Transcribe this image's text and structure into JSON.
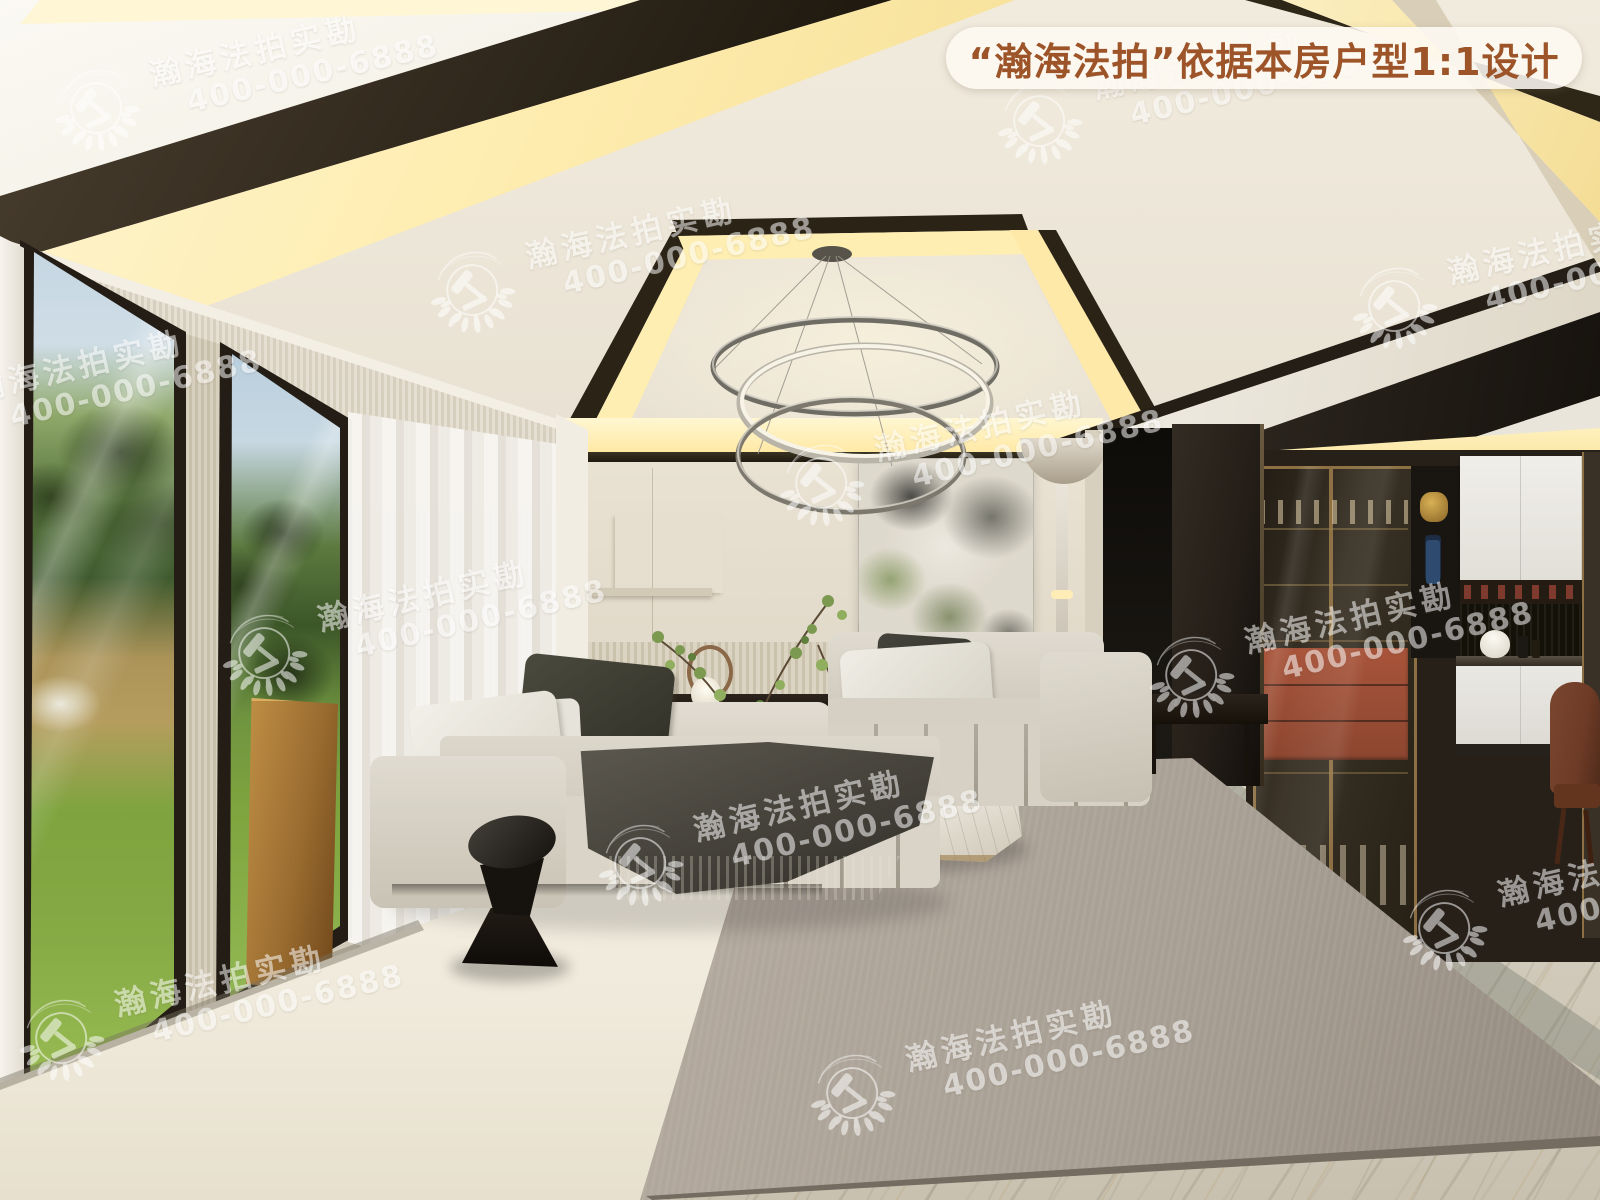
{
  "banner": {
    "text": "“瀚海法拍”依据本房户型1:1设计"
  },
  "watermark": {
    "brand": "瀚海法拍实勘",
    "phone": "400-000-6888"
  },
  "theme": {
    "banner_text": "#9c5428",
    "banner_bg": "rgba(253,249,242,0.88)",
    "watermark_color": "rgba(255,255,255,0.92)",
    "cove_glow": "#ffeeb2",
    "ceiling_cream": "#ece6d8",
    "wall_greige": "#e0d8c8",
    "rug_cream": "#f0eadc",
    "rug_grey": "#a89f94",
    "sofa_fabric": "#dcd7cb",
    "floor_marble": "#d6cfc0",
    "partition_dark": "#231d17",
    "brass": "#8c6f42",
    "accent_rust": "#a8543a",
    "grass_green": "#7ea43f",
    "chair_brown": "#6e3b26"
  }
}
